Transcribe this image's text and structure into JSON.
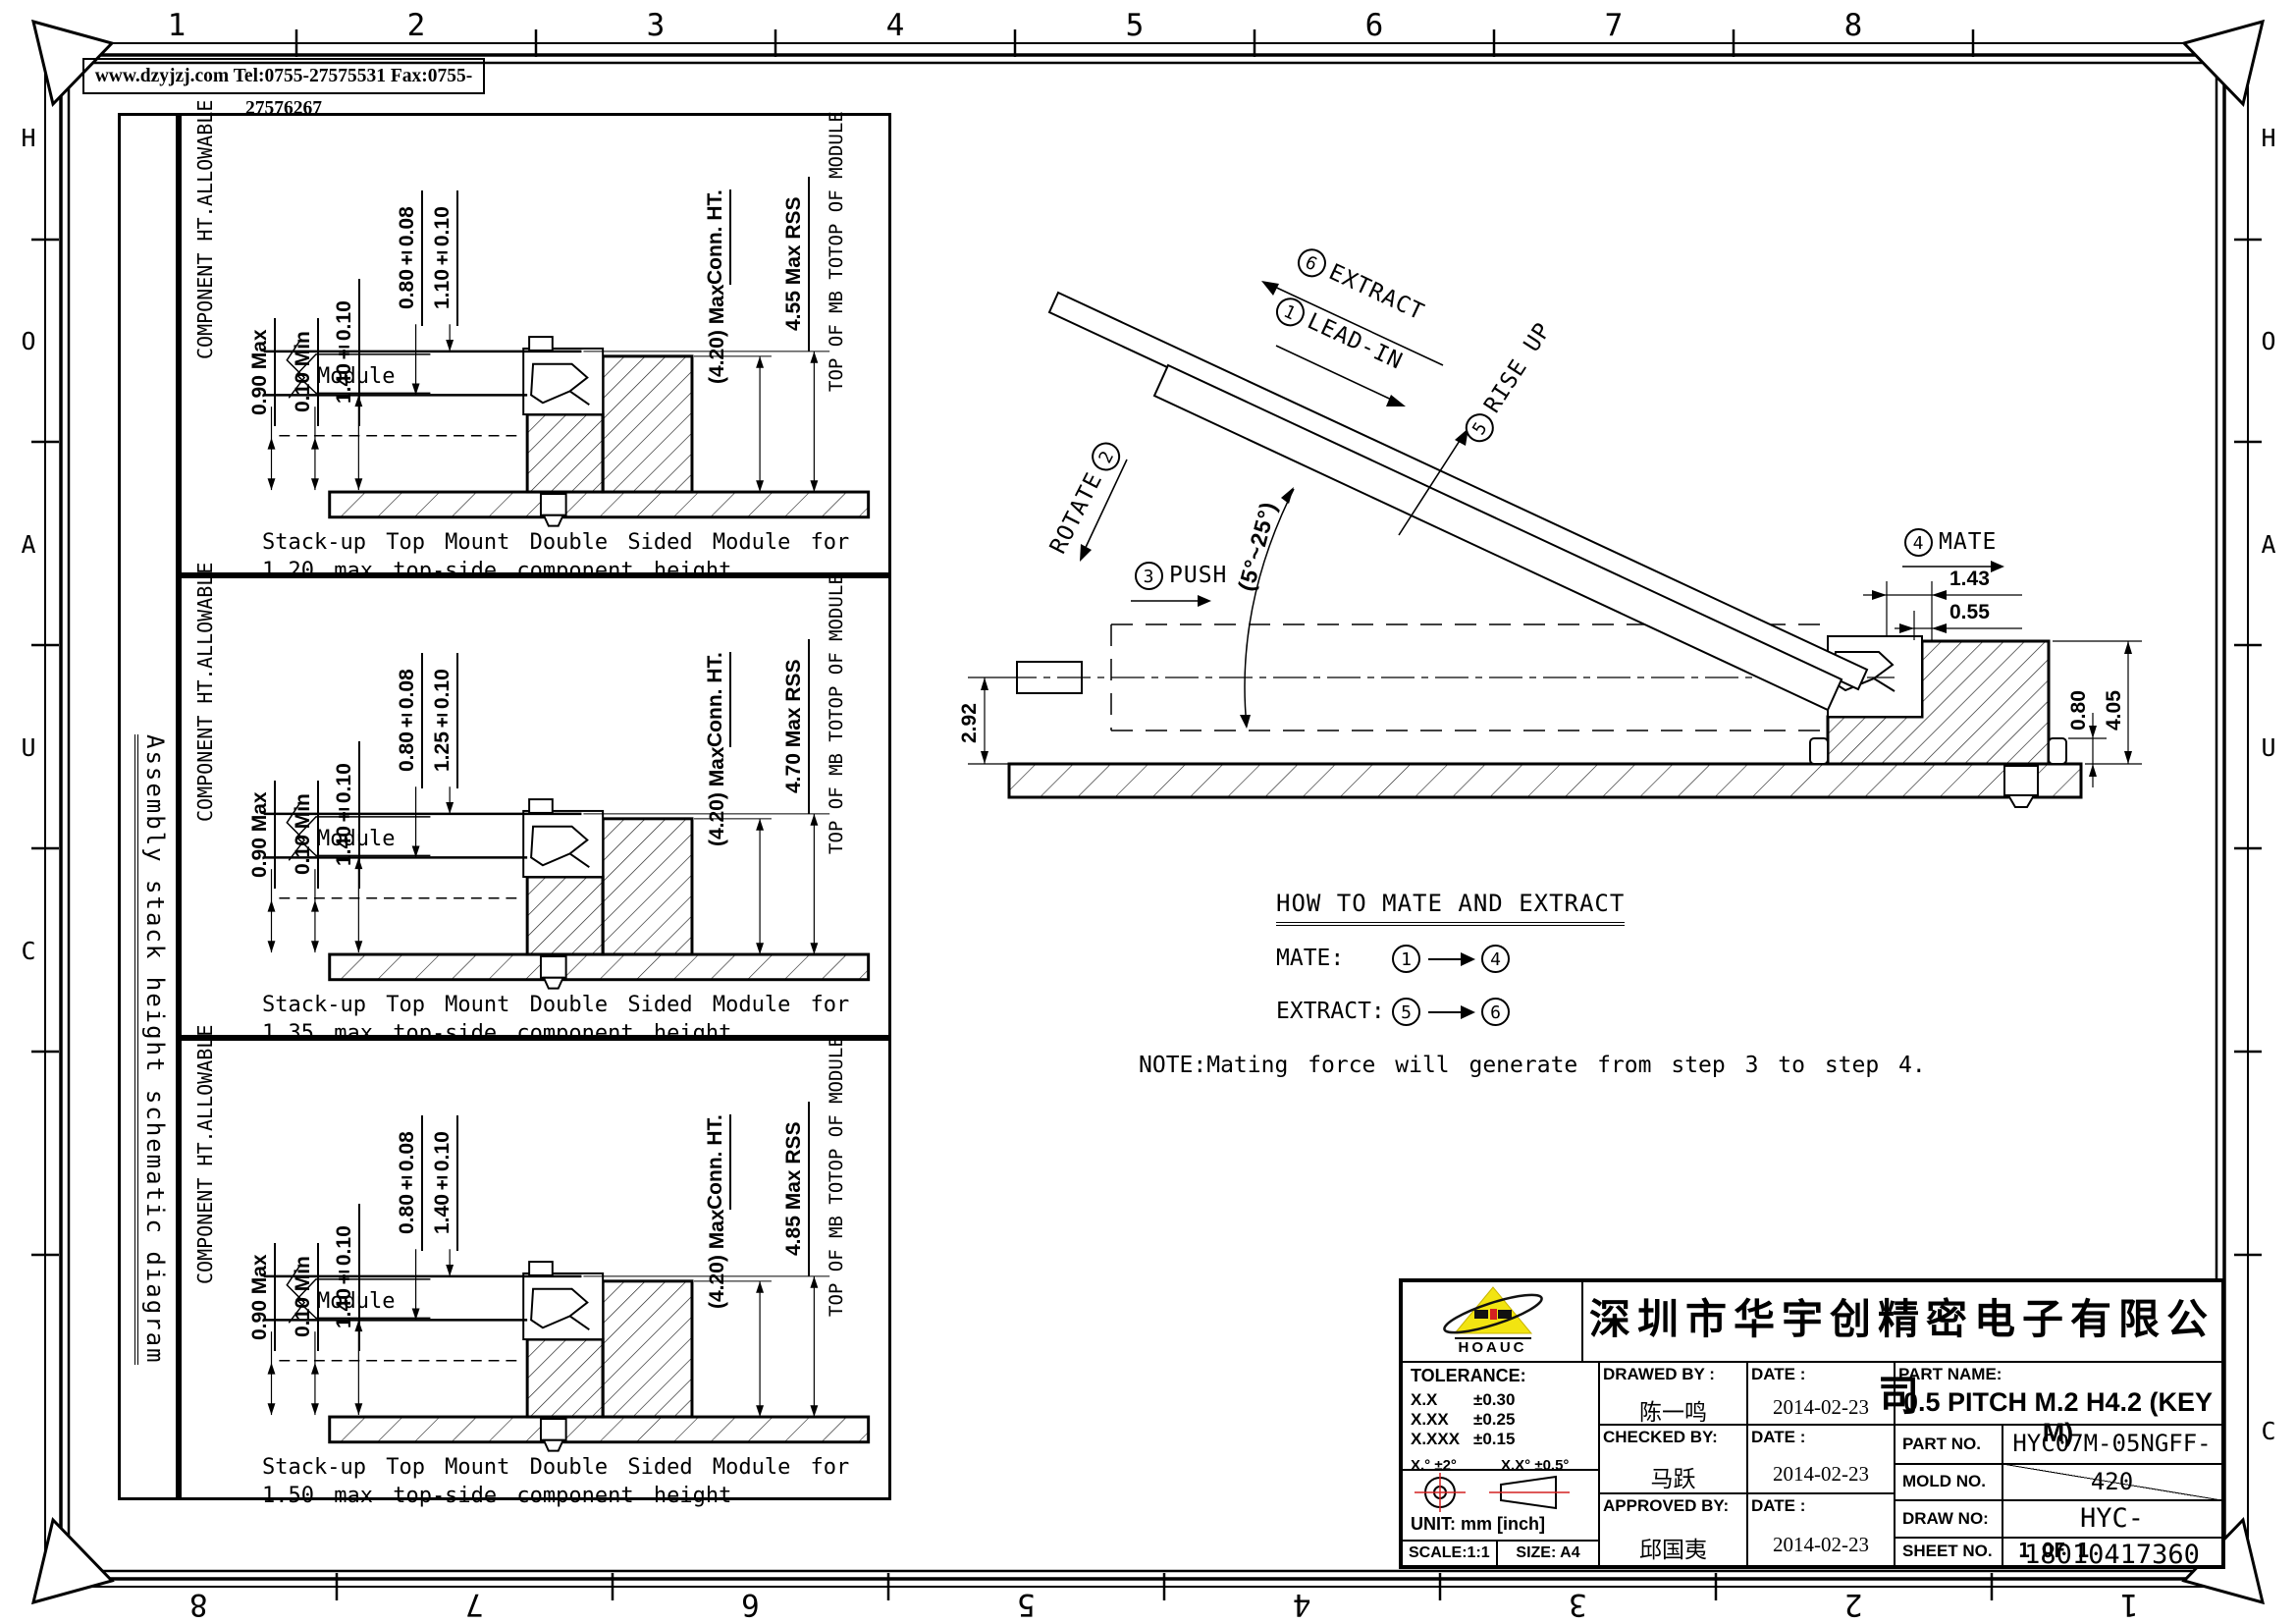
{
  "frame": {
    "website_bar": "www.dzyjzj.com  Tel:0755-27575531  Fax:0755-27576267",
    "top_zone_numbers": [
      "1",
      "2",
      "3",
      "4",
      "5",
      "6",
      "7",
      "8"
    ],
    "bottom_zone_numbers": [
      "8",
      "7",
      "6",
      "5",
      "4",
      "3",
      "2",
      "1"
    ],
    "side_zone_letters": [
      "H",
      "O",
      "A",
      "U",
      "C"
    ]
  },
  "left_panel": {
    "vertical_title": "Assembly stack height schematic diagram",
    "shared_labels": {
      "component_ht_line1": "COMPONENT HT.",
      "component_ht_line2": "ALLOWABLE",
      "max_090": "0.90 Max",
      "min_010": "0.10 Min",
      "dim_140": "1.40±0.10",
      "dim_080": "0.80±0.08",
      "module": "Module",
      "conn_ht_line1": "(4.20) Max",
      "conn_ht_line2": "Conn. HT.",
      "top_of_line1": "TOP OF  MB TO",
      "top_of_line2": "TOP OF  MODULE"
    },
    "diagrams": [
      {
        "dim_mid": "1.10±0.10",
        "rss": "4.55 Max RSS",
        "caption_line1": "Stack-up Top Mount Double Sided Module for",
        "caption_line2": "1.20 max top-side component height"
      },
      {
        "dim_mid": "1.25±0.10",
        "rss": "4.70 Max RSS",
        "caption_line1": "Stack-up Top Mount Double Sided Module for",
        "caption_line2": "1.35 max top-side component height"
      },
      {
        "dim_mid": "1.40±0.10",
        "rss": "4.85 Max RSS",
        "caption_line1": "Stack-up Top Mount Double Sided Module for",
        "caption_line2": "1.50 max top-side component height"
      }
    ]
  },
  "mate_extract": {
    "steps": {
      "extract": {
        "num": "6",
        "label": "EXTRACT"
      },
      "lead_in": {
        "num": "1",
        "label": "LEAD-IN"
      },
      "rotate": {
        "num": "2",
        "label": "ROTATE"
      },
      "push": {
        "num": "3",
        "label": "PUSH"
      },
      "mate": {
        "num": "4",
        "label": "MATE"
      },
      "rise_up": {
        "num": "5",
        "label": "RISE UP"
      }
    },
    "angle": "(5°~25°)",
    "dims": {
      "d143": "1.43",
      "d055": "0.55",
      "d080": "0.80",
      "d405": "4.05",
      "d292": "2.92"
    },
    "how_to": {
      "title": "HOW TO MATE AND EXTRACT",
      "mate_label": "MATE:",
      "mate_from": "1",
      "mate_to": "4",
      "extract_label": "EXTRACT:",
      "extract_from": "5",
      "extract_to": "6"
    },
    "note": "NOTE:Mating force will generate from step 3 to step 4."
  },
  "title_block": {
    "logo_text": "HOAUC",
    "company": "深圳市华宇创精密电子有限公司",
    "tolerance_title": "TOLERANCE:",
    "tol_r1a": "X.X",
    "tol_r1b": "±0.30",
    "tol_r2a": "X.XX",
    "tol_r2b": "±0.25",
    "tol_r3a": "X.XXX",
    "tol_r3b": "±0.15",
    "tol_ang1": "X.°  ±2°",
    "tol_ang2": "X.X°  ±0.5°",
    "unit": "UNIT:  mm  [inch]",
    "scale": "SCALE:1:1",
    "size": "SIZE:  A4",
    "people": [
      {
        "role": "DRAWED BY :",
        "name": "陈一鸣",
        "date_label": "DATE :",
        "date": "2014-02-23"
      },
      {
        "role": "CHECKED BY:",
        "name": "马跃",
        "date_label": "DATE :",
        "date": "2014-02-23"
      },
      {
        "role": "APPROVED BY:",
        "name": "邱国夷",
        "date_label": "DATE :",
        "date": "2014-02-23"
      }
    ],
    "part_name_label": "PART NAME:",
    "part_name": "0.5 PITCH M.2 H4.2 (KEY M)",
    "part_no_label": "PART NO.",
    "part_no": "HYC07M-05NGFF-420",
    "mold_no_label": "MOLD NO.",
    "draw_no_label": "DRAW NO:",
    "draw_no": "HYC-18010417360",
    "sheet_no_label": "SHEET NO.",
    "sheet_no": "1 OF 1"
  }
}
